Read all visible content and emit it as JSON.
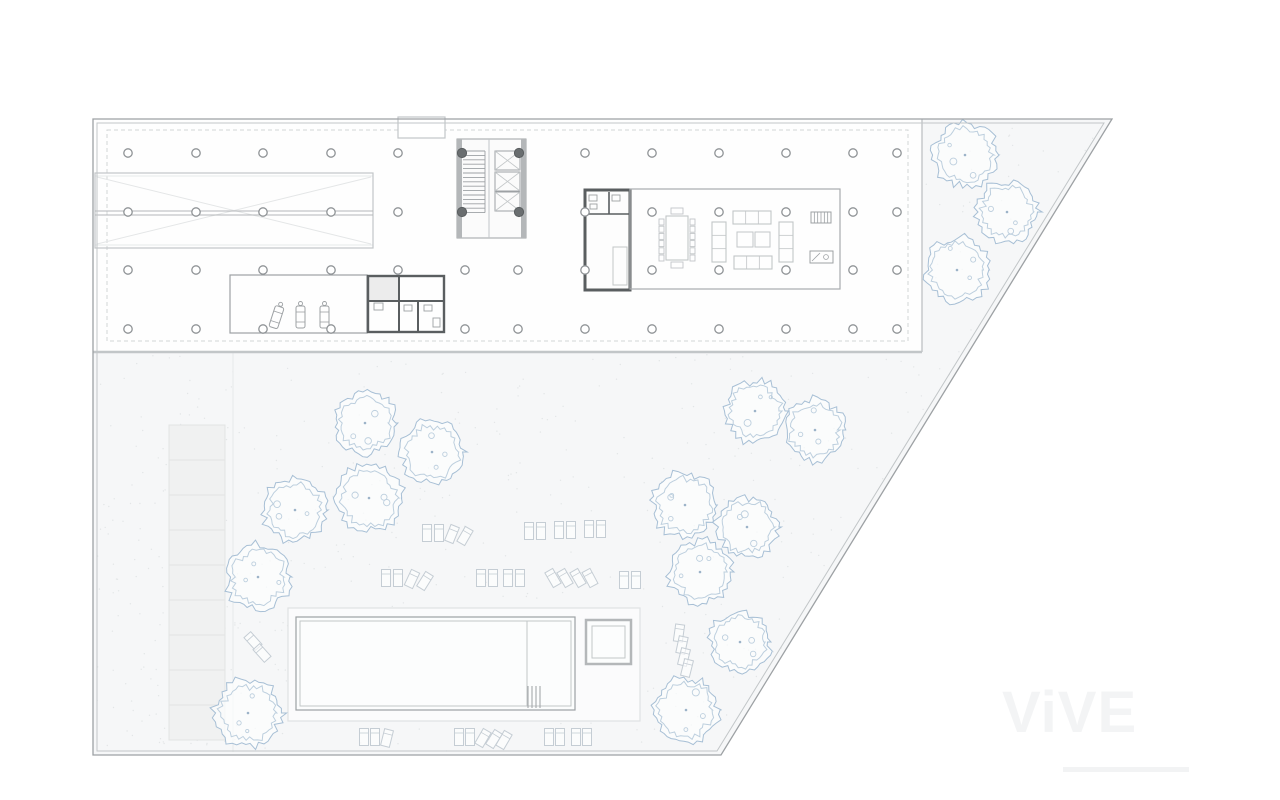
{
  "watermark": {
    "text": "ViVE"
  },
  "colors": {
    "ground": "#f6f7f8",
    "building": "#fefefe",
    "hair": "#e7e9ea",
    "faint": "#dfe2e3",
    "light": "#c2c6c8",
    "mid": "#9da1a4",
    "dark": "#5a5e60",
    "wall": "#b4b7b9",
    "column": "#8f9396",
    "column_dark": "#6a6e70",
    "tree_outer": "#a7bfd5",
    "tree_inner": "#bdcfde",
    "tree_dot": "#9cb3c8",
    "lounger": "#c5cdd4",
    "paving_fill": "#f0f1f1",
    "paving_line": "#e2e4e4",
    "dot": "#e3e6e7"
  },
  "plan": {
    "site": {
      "outer": [
        [
          93,
          119
        ],
        [
          1112,
          119
        ],
        [
          721,
          755
        ],
        [
          93,
          755
        ]
      ],
      "inner": [
        [
          97,
          123
        ],
        [
          1104,
          123
        ],
        [
          717,
          751
        ],
        [
          97,
          751
        ]
      ]
    },
    "building": {
      "rect": [
        93,
        119,
        829,
        233
      ],
      "bottom_y": 352,
      "right_x": 922,
      "notch": [
        398,
        117,
        47,
        21
      ],
      "inset_dash": [
        107,
        130,
        801,
        211
      ]
    },
    "ramp": {
      "rect": [
        95,
        173,
        278,
        75
      ],
      "mid_y1": 211,
      "mid_y2": 215
    },
    "paving": {
      "x": 169,
      "y": 425,
      "w": 56,
      "rows": 9,
      "rowh": 35
    },
    "path_line_x": 233,
    "pool": {
      "deck": [
        288,
        608,
        352,
        113
      ],
      "outer": [
        296,
        617,
        279,
        93
      ],
      "inner_offset": 4,
      "divider_x": 527,
      "ladder": [
        528,
        686,
        12,
        22
      ],
      "spa_outer": [
        586,
        620,
        45,
        44
      ],
      "spa_inner": [
        592,
        626,
        33,
        32
      ]
    },
    "bike_room": [
      230,
      275,
      137,
      58
    ],
    "vehicles": [
      [
        272,
        306,
        18
      ],
      [
        296,
        306,
        0
      ],
      [
        320,
        306,
        0
      ]
    ],
    "wc_a": {
      "rect": [
        368,
        276,
        76,
        56
      ],
      "fill_cell": [
        369,
        277,
        29,
        23
      ],
      "v1_x": 399,
      "h1_y": 301,
      "v2_x": 418,
      "fixtures": [
        [
          374,
          303,
          9,
          7
        ],
        [
          404,
          305,
          8,
          6
        ],
        [
          424,
          305,
          8,
          6
        ],
        [
          433,
          318,
          7,
          9
        ]
      ]
    },
    "wc_b": {
      "rect": [
        585,
        190,
        45,
        100
      ],
      "h1_y": 214,
      "v1_x": 609,
      "counter": [
        613,
        247,
        14,
        38
      ],
      "fixtures": [
        [
          589,
          195,
          8,
          6
        ],
        [
          612,
          195,
          8,
          6
        ],
        [
          590,
          204,
          7,
          5
        ]
      ]
    },
    "lounge": [
      630,
      189,
      210,
      100
    ],
    "core": {
      "rect": [
        457,
        139,
        69,
        99
      ],
      "wall_w": 5,
      "divider_x": 489,
      "stair": {
        "x": 463,
        "w": 22,
        "y": 151,
        "n": 15,
        "step": 4.4
      },
      "lifts": [
        [
          495,
          151
        ],
        [
          495,
          172
        ],
        [
          495,
          192
        ]
      ],
      "lift_w": 25,
      "lift_h": 19,
      "dark_columns": [
        [
          462,
          153
        ],
        [
          519,
          153
        ],
        [
          462,
          212
        ],
        [
          519,
          212
        ]
      ]
    },
    "furniture": {
      "table": [
        666,
        216,
        22,
        44
      ],
      "chairs_per_side": 6,
      "sofas_v": [
        [
          712,
          222,
          14,
          40
        ],
        [
          779,
          222,
          14,
          40
        ]
      ],
      "sofas_h": [
        [
          733,
          211,
          38,
          13
        ],
        [
          734,
          256,
          38,
          13
        ]
      ],
      "coffee": [
        [
          737,
          232,
          16,
          15
        ],
        [
          755,
          232,
          15,
          15
        ]
      ],
      "hatch_box": [
        811,
        212,
        20,
        11
      ],
      "desk": [
        810,
        251,
        23,
        12
      ]
    },
    "columns": {
      "radius": 4.2,
      "rows": [
        {
          "y": 153,
          "xs": [
            128,
            196,
            263,
            331,
            398,
            585,
            652,
            719,
            786,
            853,
            897
          ]
        },
        {
          "y": 212,
          "xs": [
            128,
            196,
            263,
            331,
            398,
            585,
            652,
            719,
            786,
            853,
            897
          ]
        },
        {
          "y": 270,
          "xs": [
            128,
            196,
            263,
            331,
            398,
            465,
            518,
            585,
            652,
            719,
            786,
            853,
            897
          ]
        },
        {
          "y": 329,
          "xs": [
            128,
            196,
            263,
            331,
            465,
            518,
            585,
            652,
            719,
            786,
            853,
            897
          ]
        }
      ]
    },
    "trees": [
      [
        965,
        155,
        35
      ],
      [
        1007,
        212,
        33
      ],
      [
        957,
        270,
        35
      ],
      [
        365,
        423,
        34
      ],
      [
        432,
        452,
        34
      ],
      [
        369,
        498,
        36
      ],
      [
        295,
        510,
        34
      ],
      [
        258,
        577,
        35
      ],
      [
        248,
        713,
        36
      ],
      [
        755,
        411,
        33
      ],
      [
        815,
        430,
        33
      ],
      [
        685,
        505,
        35
      ],
      [
        747,
        527,
        33
      ],
      [
        700,
        572,
        34
      ],
      [
        740,
        642,
        33
      ],
      [
        686,
        710,
        35
      ]
    ],
    "loungers": [
      [
        427,
        533,
        0
      ],
      [
        439,
        533,
        0
      ],
      [
        452,
        534,
        22
      ],
      [
        465,
        536,
        30
      ],
      [
        529,
        531,
        0
      ],
      [
        541,
        531,
        0
      ],
      [
        559,
        530,
        0
      ],
      [
        571,
        530,
        0
      ],
      [
        589,
        529,
        0
      ],
      [
        601,
        529,
        0
      ],
      [
        386,
        578,
        0
      ],
      [
        398,
        578,
        0
      ],
      [
        412,
        579,
        25
      ],
      [
        425,
        581,
        32
      ],
      [
        481,
        578,
        0
      ],
      [
        493,
        578,
        0
      ],
      [
        508,
        578,
        0
      ],
      [
        520,
        578,
        0
      ],
      [
        553,
        578,
        -30
      ],
      [
        565,
        578,
        -30
      ],
      [
        578,
        578,
        -30
      ],
      [
        590,
        578,
        -28
      ],
      [
        624,
        580,
        0
      ],
      [
        636,
        580,
        0
      ],
      [
        364,
        737,
        0
      ],
      [
        375,
        737,
        0
      ],
      [
        387,
        738,
        14
      ],
      [
        459,
        737,
        0
      ],
      [
        470,
        737,
        0
      ],
      [
        483,
        738,
        30
      ],
      [
        494,
        739,
        32
      ],
      [
        504,
        740,
        30
      ],
      [
        549,
        737,
        0
      ],
      [
        560,
        737,
        0
      ],
      [
        576,
        737,
        0
      ],
      [
        587,
        737,
        0
      ],
      [
        253,
        641,
        -42
      ],
      [
        262,
        653,
        -42
      ],
      [
        679,
        633,
        8
      ],
      [
        682,
        645,
        12
      ],
      [
        684,
        657,
        14
      ],
      [
        687,
        668,
        14
      ]
    ]
  }
}
